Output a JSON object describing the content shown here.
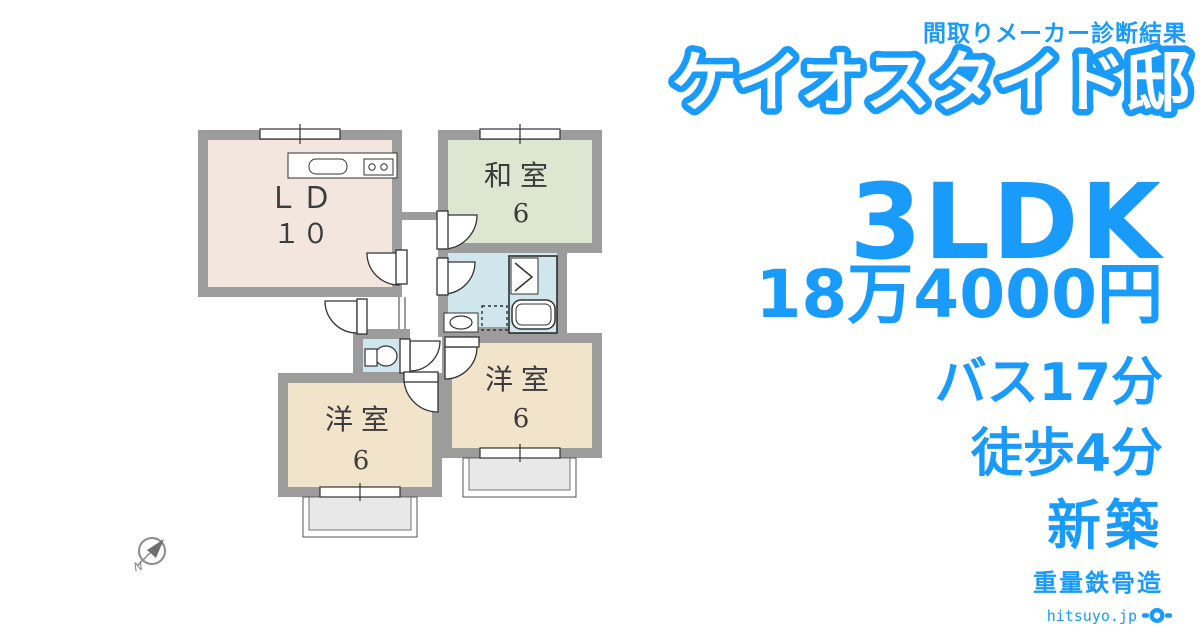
{
  "header": {
    "badge": "間取りメーカー診断結果",
    "title": "ケイオスタイド邸"
  },
  "summary": {
    "layout": "3LDK",
    "rent": "18万4000円",
    "bus": "バス17分",
    "walk": "徒歩4分",
    "built": "新築",
    "structure": "重量鉄骨造"
  },
  "floorplan": {
    "rooms": [
      {
        "name": "ＬＤ",
        "size": "１０",
        "type": "living-dining"
      },
      {
        "name": "和室",
        "size": "6",
        "type": "japanese-room"
      },
      {
        "name": "洋室",
        "size": "6",
        "type": "western-room-right"
      },
      {
        "name": "洋室",
        "size": "6",
        "type": "western-room-left"
      }
    ],
    "fixtures": [
      "kitchen-counter",
      "sink",
      "stove",
      "bathtub",
      "folding-door",
      "washbasin",
      "laundry-space",
      "toilet",
      "windows",
      "doors",
      "balconies"
    ],
    "compass_label": "N"
  },
  "footer": {
    "site": "hitsuyo.jp"
  },
  "colors": {
    "accent": "#199BFC",
    "wall": "#9C9C9C",
    "line": "#333333",
    "ld_fill": "#F2E6DF",
    "washitsu_fill": "#DCE6D0",
    "bath_fill": "#CFE7EC",
    "yoshitsu_fill": "#F2E3CB",
    "balcony_fill": "#E8E8E8",
    "label_text": "#3C3C3C"
  }
}
